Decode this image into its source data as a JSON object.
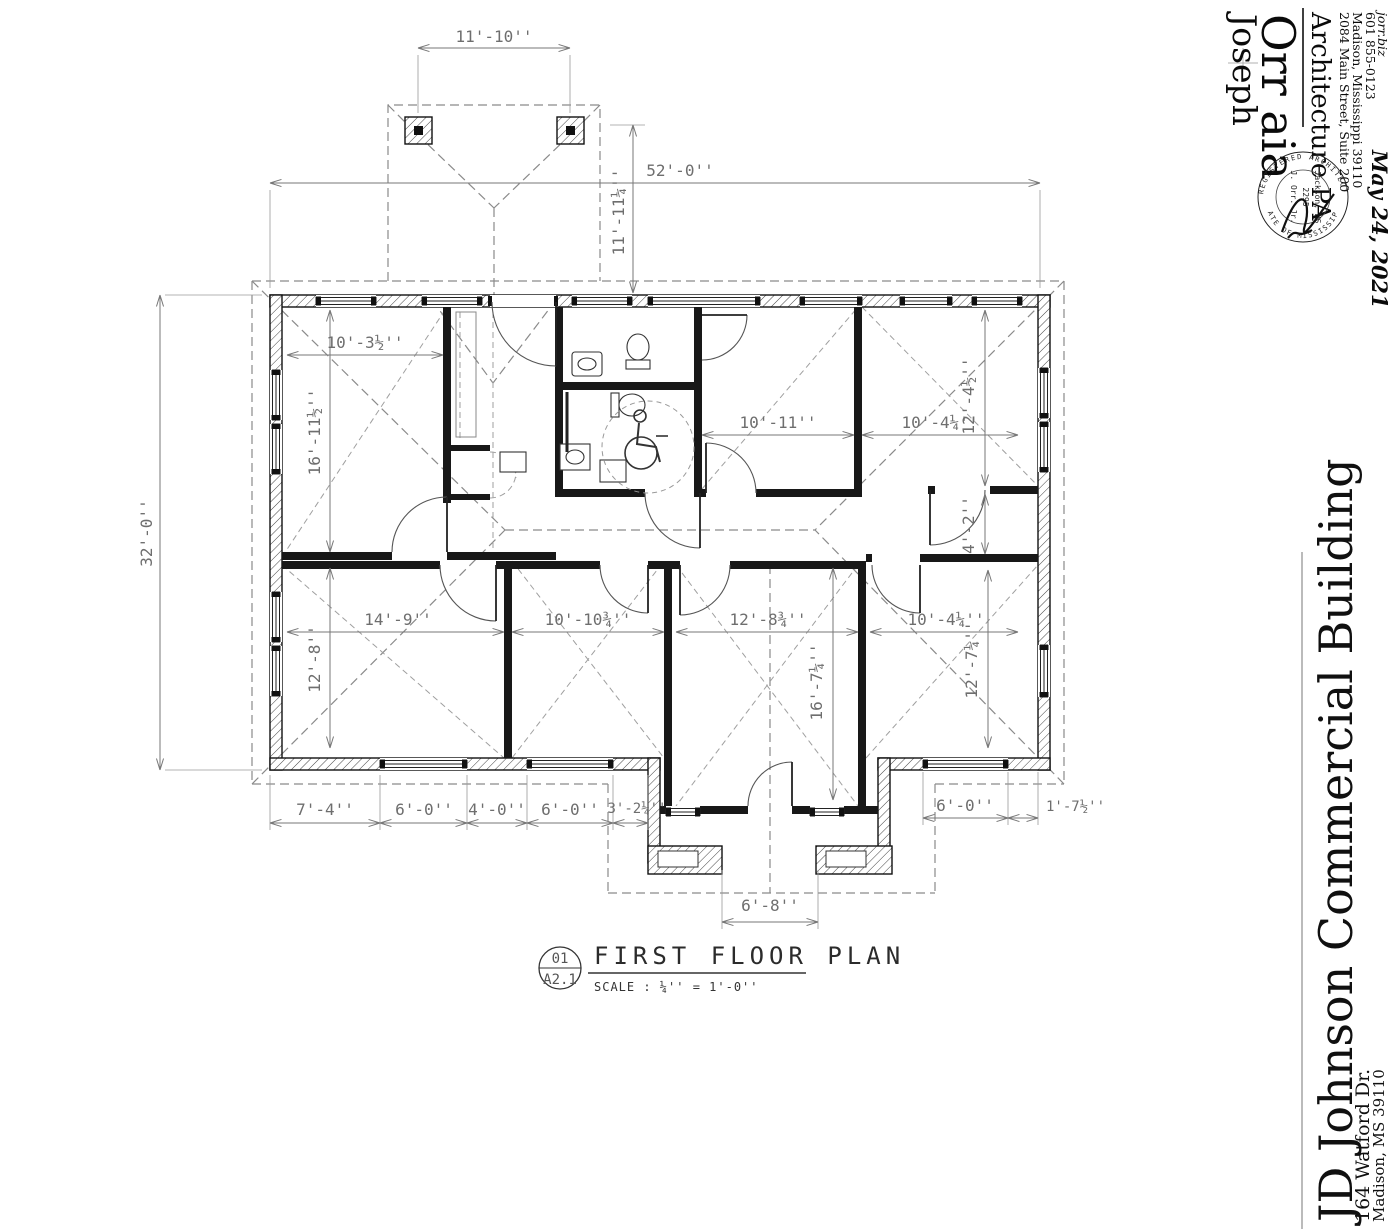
{
  "architect": {
    "logo_line1": "Joseph",
    "logo_line2": "Orr aia",
    "firm": "Architecture PA",
    "address": "2084 Main Street, Suite 200",
    "city": "Madison, Mississippi 39110",
    "phone": "601 855-0123",
    "website": "jorr.biz"
  },
  "seal": {
    "ring_top": "REGISTERED ARCHITECT",
    "ring_bottom": "STATE OF MISSISSIPPI",
    "name": "J. Orr. Jr.",
    "license": "2295",
    "city": "Jackson, MS"
  },
  "stamp_date": "May 24, 2021",
  "project": {
    "name": "JD Johnson Commercial Building",
    "address": "164 Watford Dr.",
    "city": "Madison, MS  39110"
  },
  "title_block": {
    "detail_number": "01",
    "sheet_number": "A2.1",
    "title": "FIRST FLOOR PLAN",
    "scale": "SCALE : ¼'' = 1'-0''"
  },
  "dimensions": {
    "porch_width": "11'-10''",
    "overall_width": "52'-0''",
    "porch_depth": "11'-11¼''",
    "overall_depth": "32'-0''",
    "office_nw_width": "10'-3½''",
    "office_nw_depth": "16'-11½''",
    "office_n_width": "10'-11''",
    "office_ne_width": "10'-4¼''",
    "office_ne_depth": "12'-4½''",
    "hall_east": "4'-2''",
    "office_sw_width": "14'-9''",
    "office_sw_depth": "12'-8''",
    "office_s_width": "10'-10¾''",
    "conference_width": "12'-8¾''",
    "conference_depth": "16'-7¼''",
    "office_se_width": "10'-4¼''",
    "office_se_depth": "12'-7¼''",
    "south_seg1": "7'-4''",
    "south_seg2": "6'-0''",
    "south_seg3": "4'-0''",
    "south_seg4": "6'-0''",
    "south_seg5": "3'-2¼''",
    "south_seg6": "6'-0''",
    "south_seg7": "1'-7½''",
    "entry_width": "6'-8''"
  }
}
